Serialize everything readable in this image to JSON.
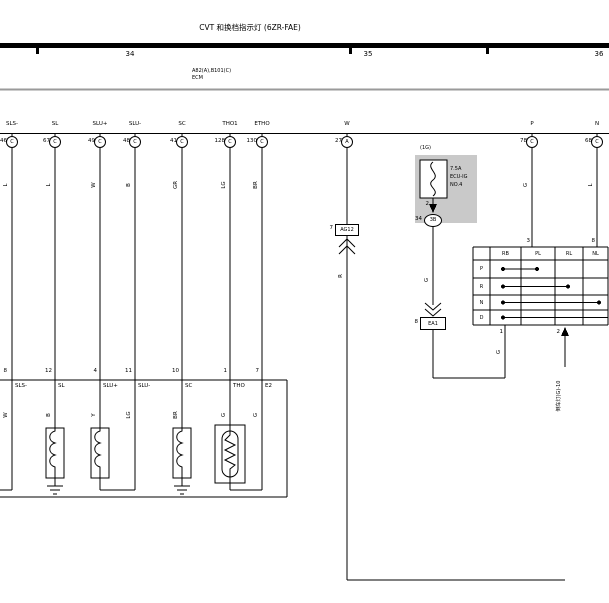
{
  "title": "CVT 和换档指示灯 (6ZR-FAE)",
  "grid": {
    "n1": "34",
    "n2": "35",
    "n3": "36"
  },
  "ecm": {
    "connectors": "A82(A),B101(C)",
    "name": "ECM"
  },
  "ecm_pins": [
    {
      "name": "SLS-",
      "num": "46",
      "conn": "C",
      "color": "L"
    },
    {
      "name": "SL",
      "num": "67",
      "conn": "C",
      "color": "L"
    },
    {
      "name": "SLU+",
      "num": "49",
      "conn": "C",
      "color": "W"
    },
    {
      "name": "SLU-",
      "num": "48",
      "conn": "C",
      "color": "B"
    },
    {
      "name": "SC",
      "num": "41",
      "conn": "C",
      "color": "GR"
    },
    {
      "name": "THO1",
      "num": "128",
      "conn": "C",
      "color": "LG"
    },
    {
      "name": "ETHO",
      "num": "130",
      "conn": "C",
      "color": "BR"
    },
    {
      "name": "W",
      "num": "27",
      "conn": "A",
      "color": "R"
    },
    {
      "name": "P",
      "num": "78",
      "conn": "C",
      "color": "G"
    },
    {
      "name": "N",
      "num": "68",
      "conn": "C",
      "color": "L"
    }
  ],
  "transmission_pins": [
    {
      "num": "8",
      "name": "SLS-",
      "color": "W"
    },
    {
      "num": "12",
      "name": "SL",
      "color": "B"
    },
    {
      "num": "4",
      "name": "SLU+",
      "color": "Y"
    },
    {
      "num": "11",
      "name": "SLU-",
      "color": "LG"
    },
    {
      "num": "10",
      "name": "SC",
      "color": "BR"
    },
    {
      "num": "1",
      "name": "THO",
      "color": "G"
    },
    {
      "num": "7",
      "name": "E2",
      "color": "G"
    }
  ],
  "fuse": {
    "connector": "(1G)",
    "rating": "7.5A",
    "name_line1": "ECU-IG",
    "name_line2": "NO.4",
    "out_pin": "2",
    "out_num": "34",
    "out_conn": "3B",
    "wire_color": "G"
  },
  "junction_w": {
    "pin": "7",
    "name": "AG12"
  },
  "junction_ig": {
    "pin": "8",
    "name": "EA1"
  },
  "shift_switch": {
    "top_pin_pl": "3",
    "top_pin_nl": "8",
    "headers": {
      "c1": "RB",
      "c2": "PL",
      "c3": "RL",
      "c4": "NL"
    },
    "rows": {
      "r1": "P",
      "r2": "R",
      "r3": "N",
      "r4": "D"
    },
    "bottom_pin_rb": "1",
    "bottom_pin_rl": "2",
    "rb_wire_color": "G"
  },
  "backup_light_ref": "倒车灯(G)-10"
}
